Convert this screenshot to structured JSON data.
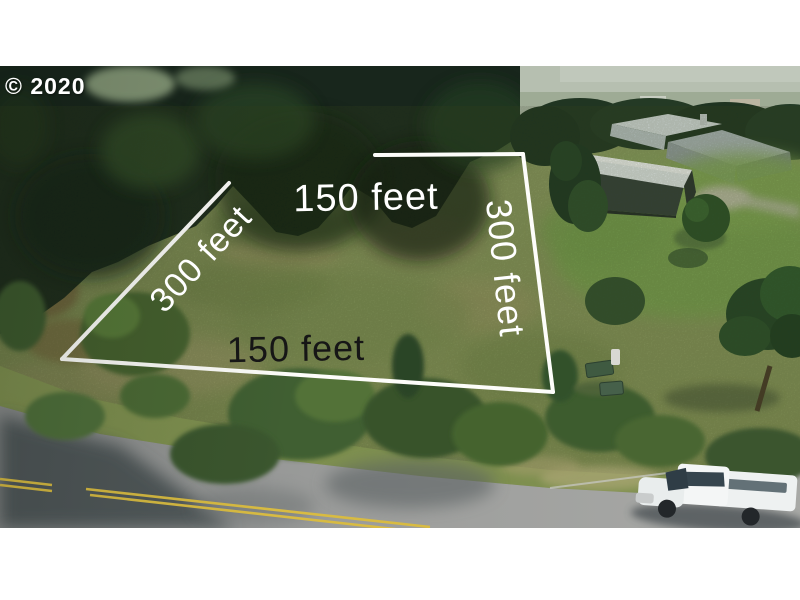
{
  "watermark": {
    "text": "© 2020"
  },
  "parcel": {
    "top_label": "150 feet",
    "left_label": "300 feet",
    "right_label": "300 feet",
    "bottom_label": "150 feet",
    "outline_color": "#fdfdfa"
  },
  "colors": {
    "letterbox_white": "#ffffff",
    "field_green": "#8f9c63",
    "forest_dark_green": "#18261c",
    "lawn_green": "#7da551",
    "road_gray": "#999b9a",
    "center_line_yellow": "#d8bb42",
    "barn_roof_white": "#edf1f3",
    "barn_body_dark": "#343f3a",
    "truck_white": "#f3f5f5",
    "label_white": "#ffffff",
    "label_black": "#161616"
  }
}
